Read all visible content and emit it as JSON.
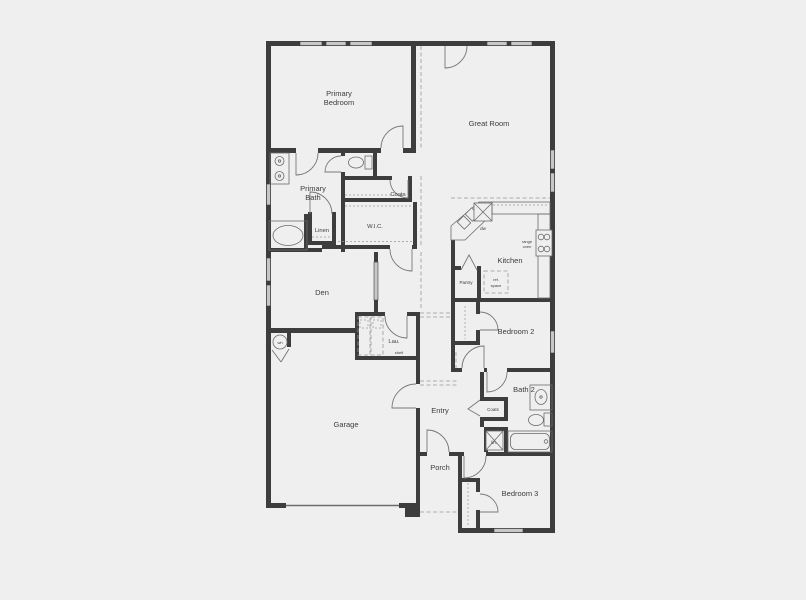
{
  "document": {
    "type": "architectural-floor-plan",
    "style": "single-story-home-blueprint"
  },
  "colors": {
    "bg": "#efefef",
    "wall": "#3d3d3d",
    "window": "#c7c7c7",
    "dash": "#999999",
    "door": "#787878",
    "fixture": "#6b6b6b",
    "label": "#3c3c3c"
  },
  "labels": {
    "primary_bedroom_1": "Primary",
    "primary_bedroom_2": "Bedroom",
    "great_room": "Great Room",
    "primary_bath_1": "Primary",
    "primary_bath_2": "Bath",
    "coats_upper": "Coats",
    "wic": "W.I.C.",
    "linen": "Linen",
    "den": "Den",
    "kitchen": "Kitchen",
    "dw": "dw",
    "range_1": "range",
    "range_2": "oven",
    "ref_1": "ref.",
    "ref_2": "space",
    "pantry": "Pantry",
    "lau": "Lau.",
    "shelf": "shelf",
    "bedroom2": "Bedroom 2",
    "bath2": "Bath 2",
    "coats_lower": "Coats",
    "lin": "lin.",
    "garage": "Garage",
    "entry": "Entry",
    "porch": "Porch",
    "bedroom3": "Bedroom 3",
    "wh": "wh"
  }
}
